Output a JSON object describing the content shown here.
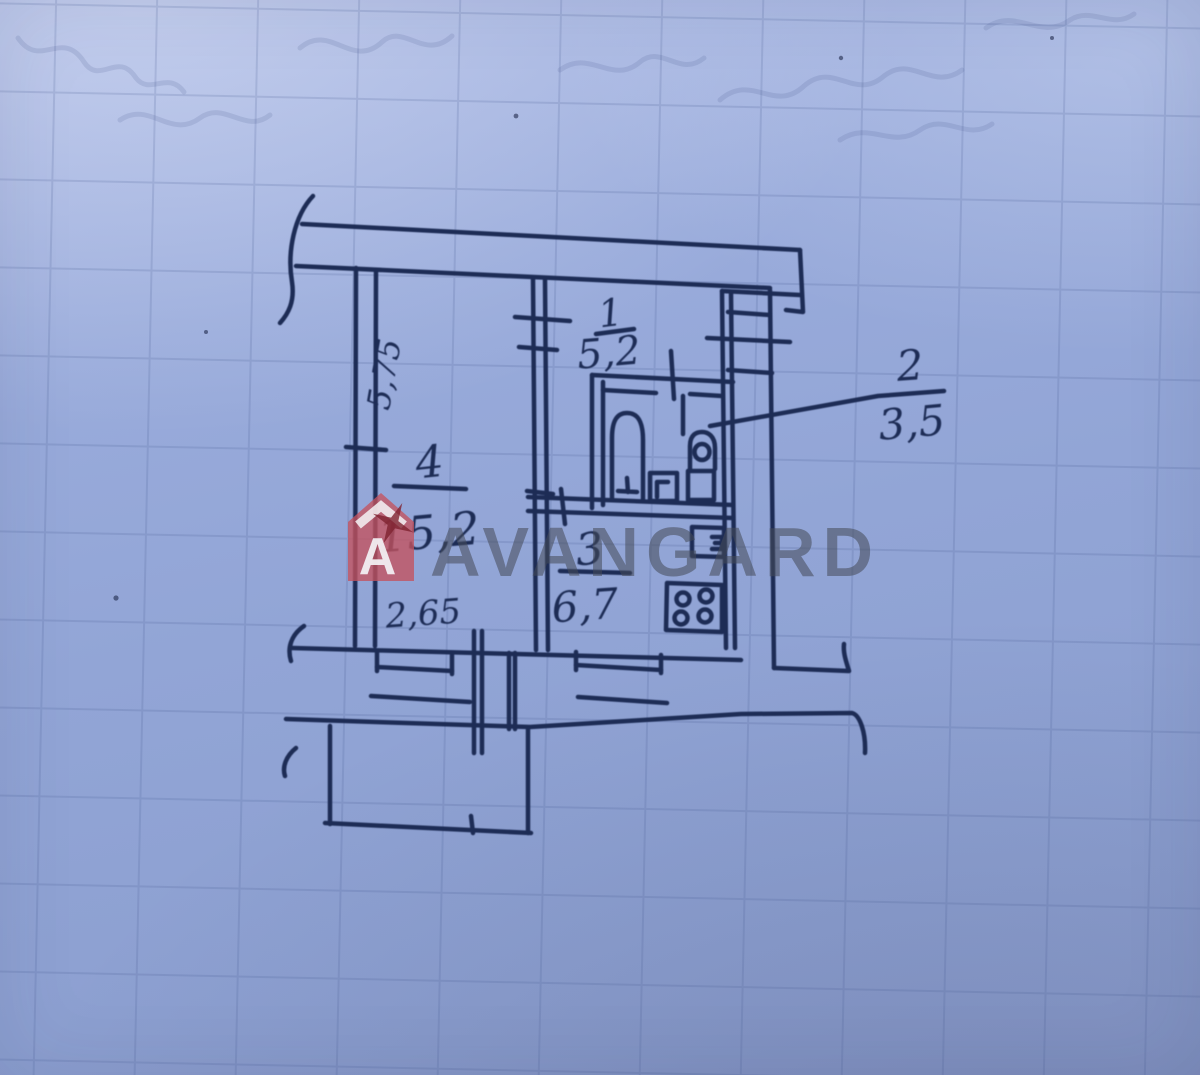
{
  "watermark": {
    "brand_text": "AVANGARD",
    "logo_letter": "A",
    "logo_color": "#c4525e",
    "star_color": "#7e2230",
    "text_color": "#454b58"
  },
  "plan": {
    "ink_color": "#1d2c55",
    "paper_color": "#92a5d6",
    "rooms": [
      {
        "number": "1",
        "area": "5,2"
      },
      {
        "number": "2",
        "area": "3,5"
      },
      {
        "number": "3",
        "area": "6,7"
      },
      {
        "number": "4",
        "area": "15,2"
      }
    ],
    "dimensions": [
      {
        "value": "5,75"
      },
      {
        "value": "2,65"
      }
    ]
  }
}
